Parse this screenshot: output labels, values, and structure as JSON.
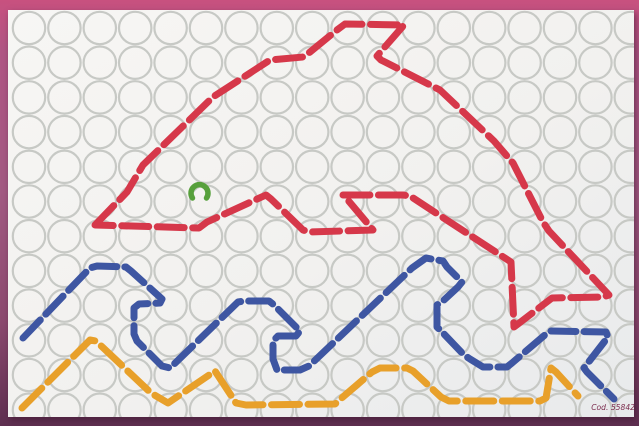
{
  "photo": {
    "frame_top_color": "#c8517f",
    "frame_bottom_color": "#5e2f50"
  },
  "board": {
    "surface_color_light": "#f6f5f3",
    "surface_color_dark": "#e8eaec",
    "hole_stroke_color": "#c7c9c5",
    "code_label": "Cod. 55842",
    "grid": {
      "start_x": 29,
      "start_y": 28,
      "pitch_x": 35.4,
      "pitch_y": 34.7,
      "cols": 18,
      "rows": 12,
      "radius": 16.2,
      "stroke_width": 2.2
    }
  },
  "artwork": {
    "dolphin_outline": {
      "color": "#d6384a",
      "dash": "27 8.5",
      "closed": true,
      "points": [
        [
          95,
          225
        ],
        [
          127,
          192
        ],
        [
          143,
          165
        ],
        [
          213,
          97
        ],
        [
          270,
          60
        ],
        [
          303,
          57
        ],
        [
          310,
          52
        ],
        [
          337,
          30
        ],
        [
          345,
          24
        ],
        [
          404,
          25
        ],
        [
          377,
          56
        ],
        [
          381,
          60
        ],
        [
          440,
          90
        ],
        [
          494,
          141
        ],
        [
          513,
          163
        ],
        [
          543,
          222
        ],
        [
          549,
          231
        ],
        [
          609,
          295
        ],
        [
          603,
          297
        ],
        [
          552,
          298
        ],
        [
          518,
          324
        ],
        [
          514,
          327
        ],
        [
          511,
          262
        ],
        [
          410,
          196
        ],
        [
          403,
          195
        ],
        [
          343,
          195
        ],
        [
          347,
          199
        ],
        [
          373,
          230
        ],
        [
          310,
          232
        ],
        [
          303,
          230
        ],
        [
          271,
          199
        ],
        [
          266,
          195
        ],
        [
          207,
          222
        ],
        [
          199,
          228
        ]
      ]
    },
    "waves_blue": {
      "color": "#3e56a2",
      "dash": "25 8",
      "closed": false,
      "points": [
        [
          23,
          338
        ],
        [
          90,
          268
        ],
        [
          97,
          266
        ],
        [
          126,
          267
        ],
        [
          131,
          271
        ],
        [
          162,
          299
        ],
        [
          160,
          303
        ],
        [
          139,
          304
        ],
        [
          134,
          308
        ],
        [
          134,
          334
        ],
        [
          137,
          341
        ],
        [
          162,
          366
        ],
        [
          170,
          368
        ],
        [
          238,
          302
        ],
        [
          244,
          301
        ],
        [
          269,
          301
        ],
        [
          274,
          305
        ],
        [
          300,
          331
        ],
        [
          296,
          336
        ],
        [
          278,
          336
        ],
        [
          273,
          341
        ],
        [
          273,
          359
        ],
        [
          277,
          370
        ],
        [
          300,
          370
        ],
        [
          309,
          366
        ],
        [
          412,
          268
        ],
        [
          426,
          258
        ],
        [
          443,
          261
        ],
        [
          447,
          267
        ],
        [
          462,
          282
        ],
        [
          458,
          287
        ],
        [
          444,
          300
        ],
        [
          437,
          305
        ],
        [
          437,
          327
        ],
        [
          444,
          334
        ],
        [
          464,
          355
        ],
        [
          470,
          359
        ],
        [
          483,
          367
        ],
        [
          507,
          367
        ],
        [
          512,
          363
        ],
        [
          546,
          334
        ],
        [
          551,
          331
        ],
        [
          606,
          332
        ],
        [
          608,
          337
        ],
        [
          584,
          368
        ],
        [
          587,
          372
        ],
        [
          614,
          399
        ]
      ]
    },
    "waves_orange": {
      "color": "#e8a02a",
      "dash": "28 8.5",
      "closed": false,
      "points": [
        [
          22,
          408
        ],
        [
          90,
          340
        ],
        [
          96,
          341
        ],
        [
          151,
          393
        ],
        [
          168,
          403
        ],
        [
          215,
          371
        ],
        [
          236,
          403
        ],
        [
          246,
          405
        ],
        [
          335,
          404
        ],
        [
          344,
          396
        ],
        [
          372,
          372
        ],
        [
          380,
          368
        ],
        [
          407,
          368
        ],
        [
          413,
          371
        ],
        [
          441,
          397
        ],
        [
          449,
          401
        ],
        [
          540,
          401
        ],
        [
          546,
          398
        ],
        [
          551,
          368
        ],
        [
          556,
          372
        ],
        [
          578,
          396
        ]
      ]
    },
    "eye_piece": {
      "color": "#57a03c",
      "foot_left_x": 192.5,
      "foot_right_x": 206.5,
      "feet_y": 198,
      "radius": 8.5,
      "stroke_width": 5.5
    }
  }
}
